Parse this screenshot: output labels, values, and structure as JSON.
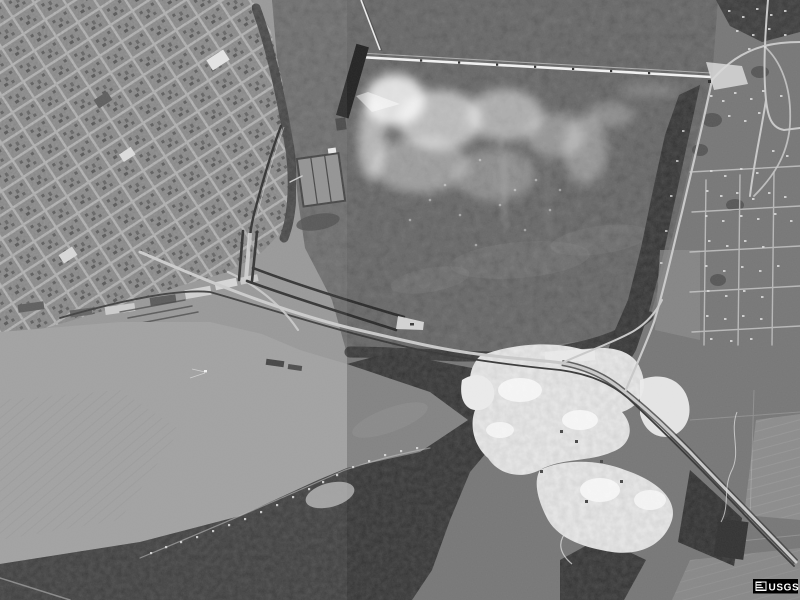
{
  "watermark": {
    "label": "USGS"
  },
  "palette": {
    "left_base": "#949494",
    "right_base": "#777777",
    "water": "#5d5d5d",
    "flats": "#9d9d9d",
    "water_tongue": "#838383",
    "city_block": "#8f8f8f",
    "street": "#b7b7b7",
    "road": "#c9c9c9",
    "rail": "#383838",
    "woods": "#4a4a4a",
    "field": "#8c8c8c",
    "quarry": "#ebebeb",
    "structure": "#232323",
    "foam": "#ffffff",
    "logo_bg": "#000000",
    "logo_fg": "#ffffff"
  }
}
